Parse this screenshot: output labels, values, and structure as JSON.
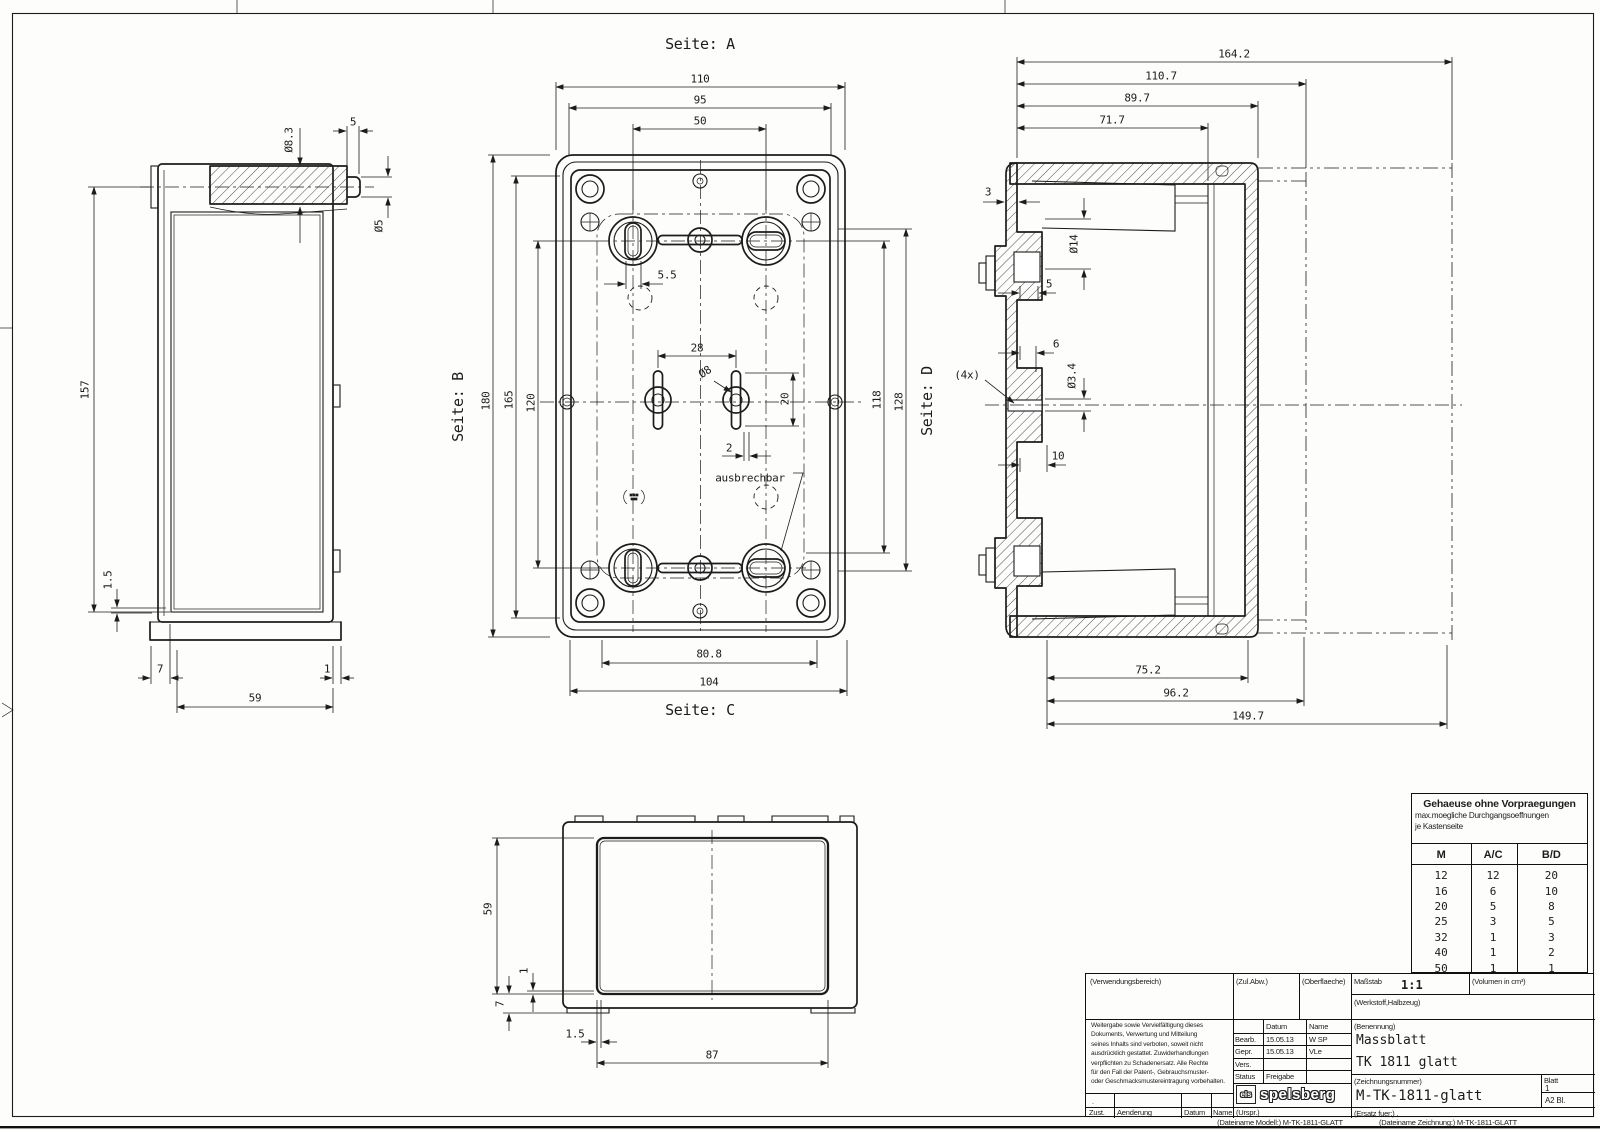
{
  "views": {
    "a": "Seite: A",
    "b": "Seite: B",
    "c": "Seite: C",
    "d": "Seite: D"
  },
  "annotations": {
    "ausbrechbar": "ausbrechbar",
    "qty4x": "(4x)"
  },
  "dims": {
    "left": {
      "dia83": "Ø8.3",
      "w5": "5",
      "dia5": "Ø5",
      "h157": "157",
      "t15": "1.5",
      "b7": "7",
      "b1": "1",
      "b59": "59"
    },
    "front": {
      "w110": "110",
      "w95": "95",
      "w50": "50",
      "h180": "180",
      "h165": "165",
      "h120": "120",
      "h118": "118",
      "h128": "128",
      "s55": "5.5",
      "s28": "28",
      "dia8": "Ø8",
      "s20": "20",
      "s2": "2",
      "b808": "80.8",
      "b104": "104"
    },
    "section": {
      "w1642": "164.2",
      "w1107": "110.7",
      "w897": "89.7",
      "w717": "71.7",
      "t3": "3",
      "dia14": "Ø14",
      "s5": "5",
      "s6": "6",
      "dia34": "Ø3.4",
      "s10": "10",
      "b752": "75.2",
      "b962": "96.2",
      "b1497": "149.7"
    },
    "bottom": {
      "h59": "59",
      "t1": "1",
      "t7": "7",
      "t15": "1.5",
      "w87": "87"
    }
  },
  "knockout_table": {
    "title": "Gehaeuse ohne Vorpraegungen",
    "subtitle1": "max.moegliche Durchgangsoeffnungen",
    "subtitle2": "je Kastenseite",
    "headers": [
      "M",
      "A/C",
      "B/D"
    ],
    "rows": [
      [
        "12",
        "12",
        "20"
      ],
      [
        "16",
        "6",
        "10"
      ],
      [
        "20",
        "5",
        "8"
      ],
      [
        "25",
        "3",
        "5"
      ],
      [
        "32",
        "1",
        "3"
      ],
      [
        "40",
        "1",
        "2"
      ],
      [
        "50",
        "1",
        "1"
      ]
    ]
  },
  "title_block": {
    "verwendungsbereich": "(Verwendungsbereich)",
    "zul_abw": "(Zul.Abw.)",
    "oberflaeche": "(Oberflaeche)",
    "massstab_label": "Maßstab",
    "massstab": "1:1",
    "volumen": "(Volumen in cm³)",
    "werkstoff": "(Werkstoff,Halbzeug)",
    "legal": [
      "Weitergabe sowie Vervielfältigung dieses",
      "Dokuments, Verwertung und Mitteilung",
      "seines Inhalts sind verboten, soweit nicht",
      "ausdrücklich gestattet. Zuwiderhandlungen",
      "verpflichten zu Schadenersatz. Alle Rechte",
      "für den Fall der Patent-, Gebrauchsmuster-",
      "oder Geschmacksmustereintragung vorbehalten."
    ],
    "datum_header": "Datum",
    "name_header": "Name",
    "bearb_label": "Bearb.",
    "bearb_datum": "15.05.13",
    "bearb_name": "W SP",
    "gepr_label": "Gepr.",
    "gepr_datum": "15.05.13",
    "gepr_name": "VLe",
    "vers_label": "Vers.",
    "status_label": "Status",
    "status_value": "Freigabe",
    "benennung_label": "(Benennung)",
    "benennung_line1": "Massblatt",
    "benennung_line2": "TK 1811 glatt",
    "zeichnungsnummer_label": "(Zeichnungsnummer)",
    "zeichnungsnummer": "M-TK-1811-glatt",
    "blatt_label": "Blatt",
    "blatt_nr": "1",
    "format": "A2  Bl.",
    "ersatz": "(Ersatz fuer:)  .",
    "zust": "Zust.",
    "aenderung": "Aenderung",
    "datum2": "Datum",
    "name2": "Name",
    "urspr": "(Urspr.)",
    "dot": ".",
    "logo_els": "els",
    "logo_name": "spelsberg"
  },
  "footer": {
    "dateiname_modell": "(Dateiname Modell:) M-TK-1811-GLATT",
    "dateiname_zeichnung": "(Dateiname Zeichnung:) M-TK-1811-GLATT"
  }
}
